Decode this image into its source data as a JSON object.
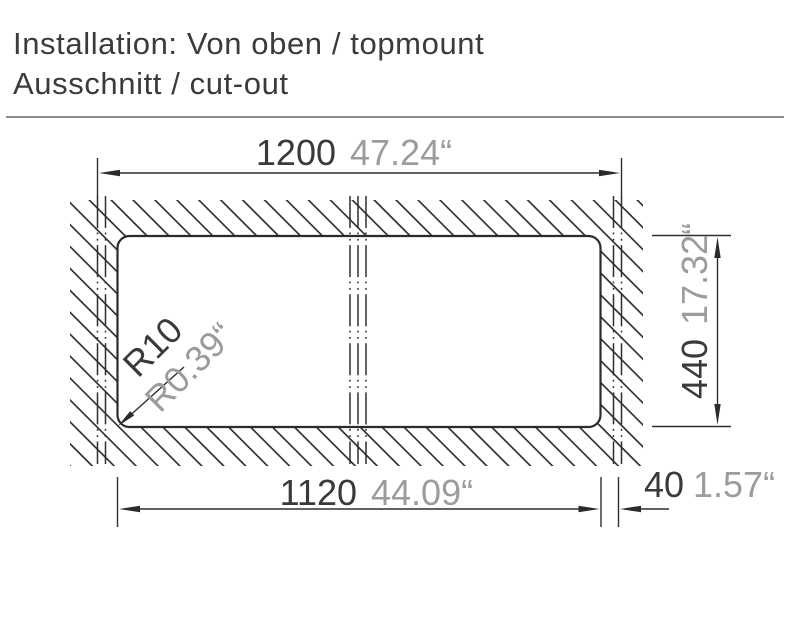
{
  "header": {
    "line1": "Installation: Von oben / topmount",
    "line2": "Ausschnitt / cut-out"
  },
  "dims": {
    "width": {
      "mm": "1200",
      "inch": "47.24“"
    },
    "height": {
      "mm": "440",
      "inch": "17.32“"
    },
    "cutout": {
      "mm": "1120",
      "inch": "44.09“"
    },
    "offset": {
      "mm": "40",
      "inch": "1.57“"
    },
    "radius": {
      "mm": "R10",
      "inch": "R0.39“"
    }
  },
  "colors": {
    "line": "#2f2f2f",
    "mm_text": "#3a3a3a",
    "inch_text": "#9c9c9c",
    "separator": "#8d8d8d",
    "background": "#ffffff"
  }
}
